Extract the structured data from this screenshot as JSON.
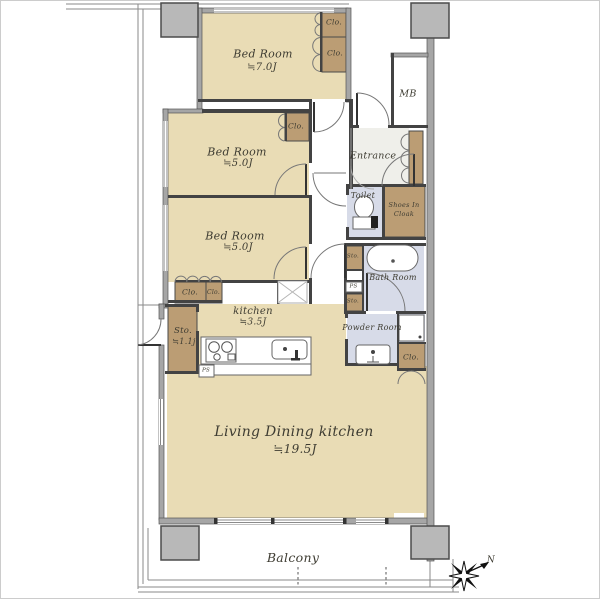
{
  "plan": {
    "rooms": {
      "bedroom_top": {
        "name": "Bed Room",
        "size": "≒7.0J"
      },
      "bedroom_mid": {
        "name": "Bed Room",
        "size": "≒5.0J"
      },
      "bedroom_low": {
        "name": "Bed Room",
        "size": "≒5.0J"
      },
      "kitchen": {
        "name": "kitchen",
        "size": "≒3.5J"
      },
      "ldk": {
        "name": "Living Dining kitchen",
        "size": "≒19.5J"
      },
      "storage": {
        "name": "Sto.",
        "size": "≒1.1j"
      },
      "entrance": {
        "name": "Entrance"
      },
      "meter_box": {
        "name": "MB"
      },
      "toilet": {
        "name": "Toilet"
      },
      "shoes_in_cloak": {
        "line1": "Shoes In",
        "line2": "Cloak"
      },
      "bath": {
        "name": "Bath Room"
      },
      "powder": {
        "name": "Powder Room"
      },
      "balcony": {
        "name": "Balcony"
      }
    },
    "tags": {
      "closet": "Clo.",
      "storage_small": "Sto.",
      "pipe_space": "PS"
    },
    "compass": {
      "north": "N"
    },
    "colors": {
      "room_fill": "#e9dcb5",
      "closet_fill": "#bb9d74",
      "wet_fill": "#d7dbe8",
      "pillar_fill": "#b8b8b8",
      "wall_dark": "#434343",
      "wall_grey": "#a6a6a6"
    }
  }
}
